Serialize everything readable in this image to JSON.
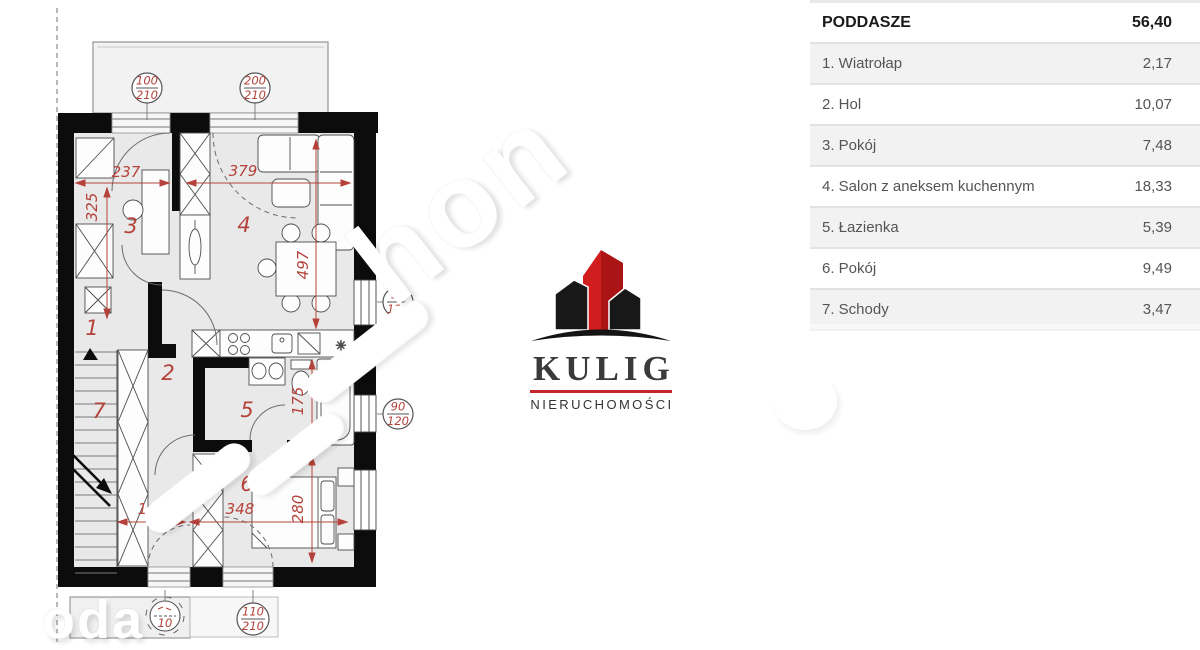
{
  "floor_plan": {
    "room_labels": {
      "r1": "1",
      "r2": "2",
      "r3": "3",
      "r4": "4",
      "r5": "5",
      "r6": "6",
      "r7": "7"
    },
    "dimensions": {
      "w237": "237",
      "h325": "325",
      "w379": "379",
      "h497": "497",
      "h175": "175",
      "h280": "280",
      "w160": "160",
      "w348": "348"
    },
    "openings": {
      "balcony_door_1": {
        "num": "100",
        "den": "210"
      },
      "balcony_door_2": {
        "num": "200",
        "den": "210"
      },
      "window_right_1": {
        "num": "90",
        "den": "120"
      },
      "window_right_2": {
        "num": "90",
        "den": "120"
      },
      "terrace_door": {
        "num": "110",
        "den": "210"
      },
      "terrace_door_partial": {
        "den": "10"
      }
    },
    "colors": {
      "wall": "#0c0c0c",
      "room_fill": "#e9e9e9",
      "dimension_red": "#b5423a"
    }
  },
  "logo": {
    "name": "KULIG",
    "subtitle": "NIERUCHOMOŚCI",
    "accent_color": "#c1272d"
  },
  "watermark": {
    "diagonal_text": "hon",
    "corner_text": "oda"
  },
  "area_table": {
    "header": {
      "label": "PODDASZE",
      "value": "56,40"
    },
    "rows": [
      {
        "label": "1. Wiatrołap",
        "value": "2,17"
      },
      {
        "label": "2. Hol",
        "value": "10,07"
      },
      {
        "label": "3. Pokój",
        "value": "7,48"
      },
      {
        "label": "4. Salon z aneksem kuchennym",
        "value": "18,33"
      },
      {
        "label": "5. Łazienka",
        "value": "5,39"
      },
      {
        "label": "6. Pokój",
        "value": "9,49"
      },
      {
        "label": "7. Schody",
        "value": "3,47"
      }
    ]
  }
}
